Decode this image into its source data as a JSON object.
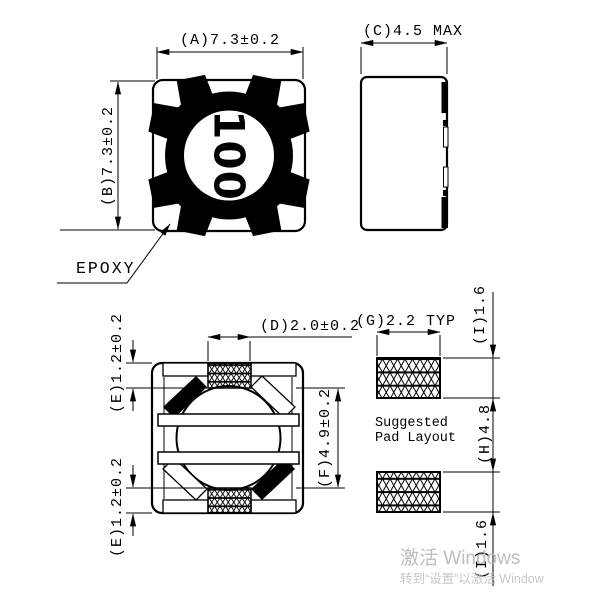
{
  "views": {
    "top_view": {
      "dim_a": "(A)7.3±0.2",
      "dim_b": "(B)7.3±0.2",
      "part_marking": "100",
      "epoxy_label": "EPOXY"
    },
    "side_view": {
      "dim_c": "(C)4.5 MAX"
    },
    "bottom_view": {
      "dim_d": "(D)2.0±0.2",
      "dim_e_top": "(E)1.2±0.2",
      "dim_e_bottom": "(E)1.2±0.2",
      "dim_f": "(F)4.9±0.2"
    },
    "pad_layout": {
      "dim_g": "(G)2.2 TYP",
      "dim_i_top": "(I)1.6",
      "dim_h": "(H)4.8",
      "dim_i_bottom": "(I)1.6",
      "caption_line1": "Suggested",
      "caption_line2": "Pad Layout"
    }
  },
  "watermark": {
    "line1": "激活 Windows",
    "line2": "转到“设置”以激活 Window"
  },
  "colors": {
    "line": "#000000",
    "watermark": "#bdbdbd",
    "background": "#ffffff"
  }
}
